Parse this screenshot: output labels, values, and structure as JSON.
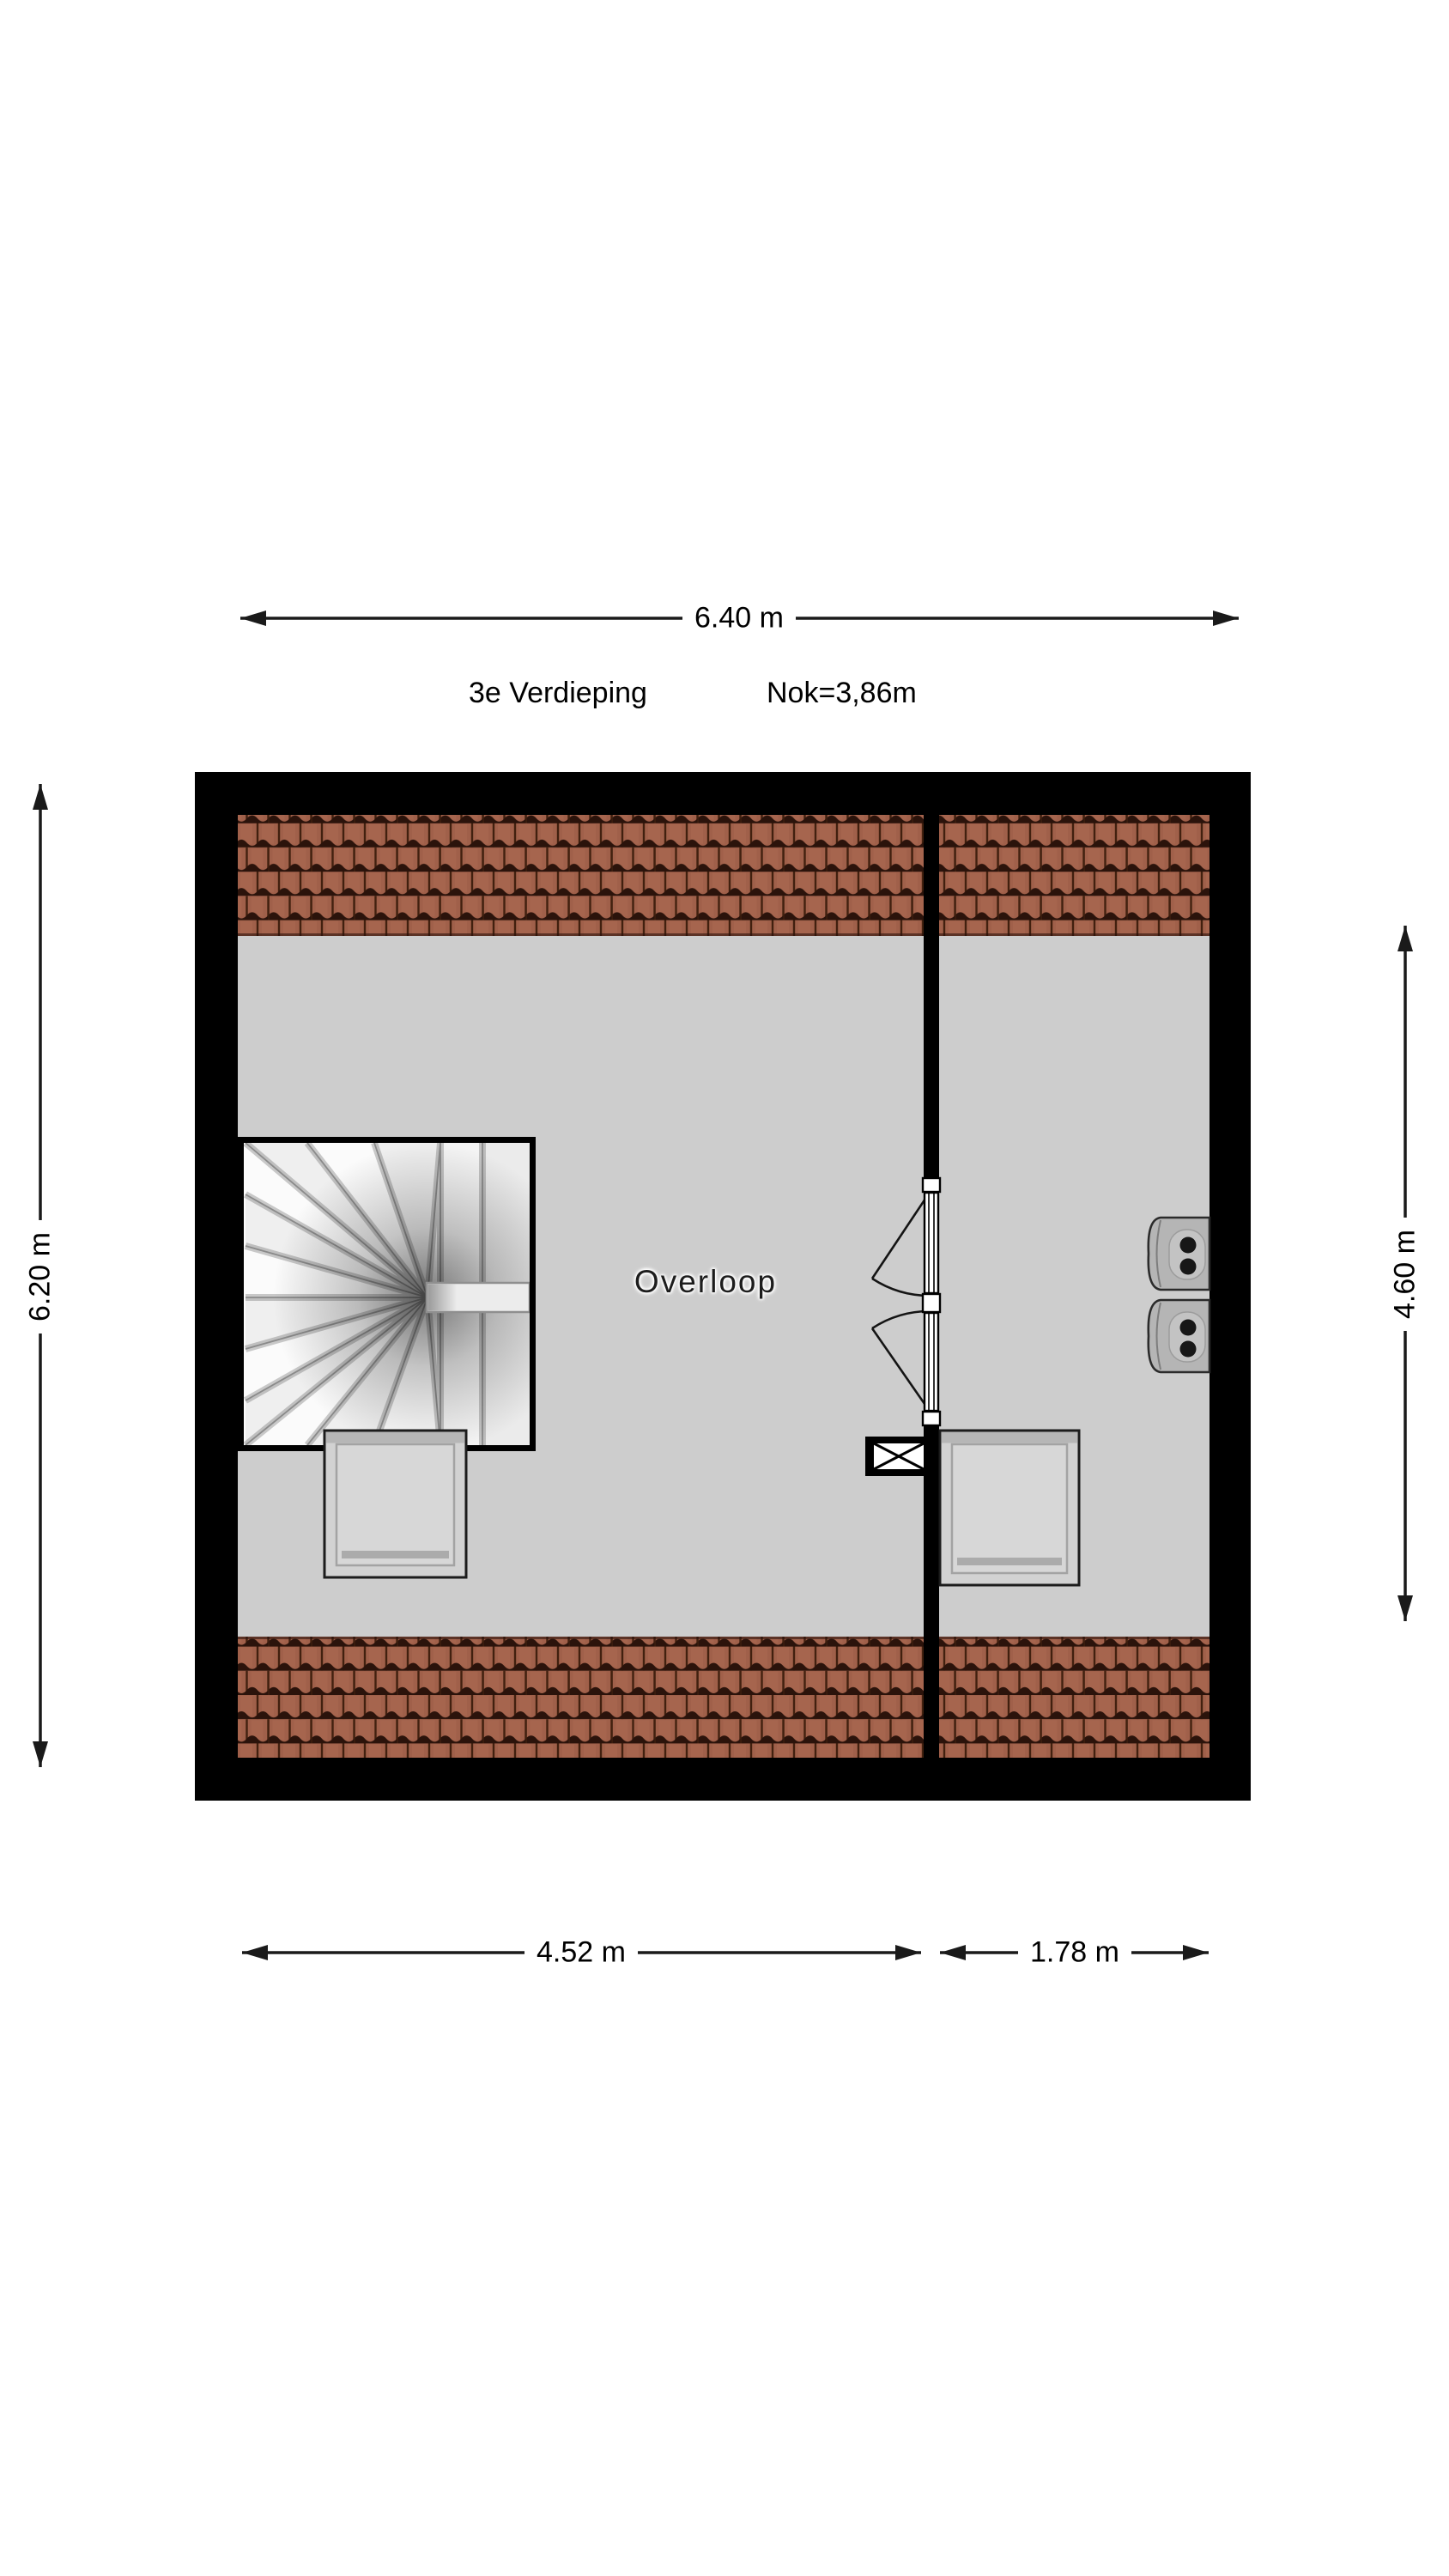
{
  "header": {
    "floor_label": "3e Verdieping",
    "ridge_label": "Nok=3,86m"
  },
  "rooms": [
    {
      "name": "Overloop"
    }
  ],
  "dimensions": {
    "top_width": "6.40 m",
    "left_depth": "6.20 m",
    "right_depth": "4.60 m",
    "bottom_left_width": "4.52 m",
    "bottom_right_width": "1.78 m"
  },
  "symbols": {
    "staircase": "winder-staircase",
    "door": "double-swing-door",
    "shaft": "duct-shaft",
    "skylights": 2,
    "boilers": 2
  },
  "colors": {
    "background": "#ffffff",
    "wall": "#000000",
    "floor": "#cdcdcd",
    "roof_tile": "#a0604a",
    "roof_tile_gap": "#2b130b",
    "dimension_line": "#1a1a1a"
  }
}
